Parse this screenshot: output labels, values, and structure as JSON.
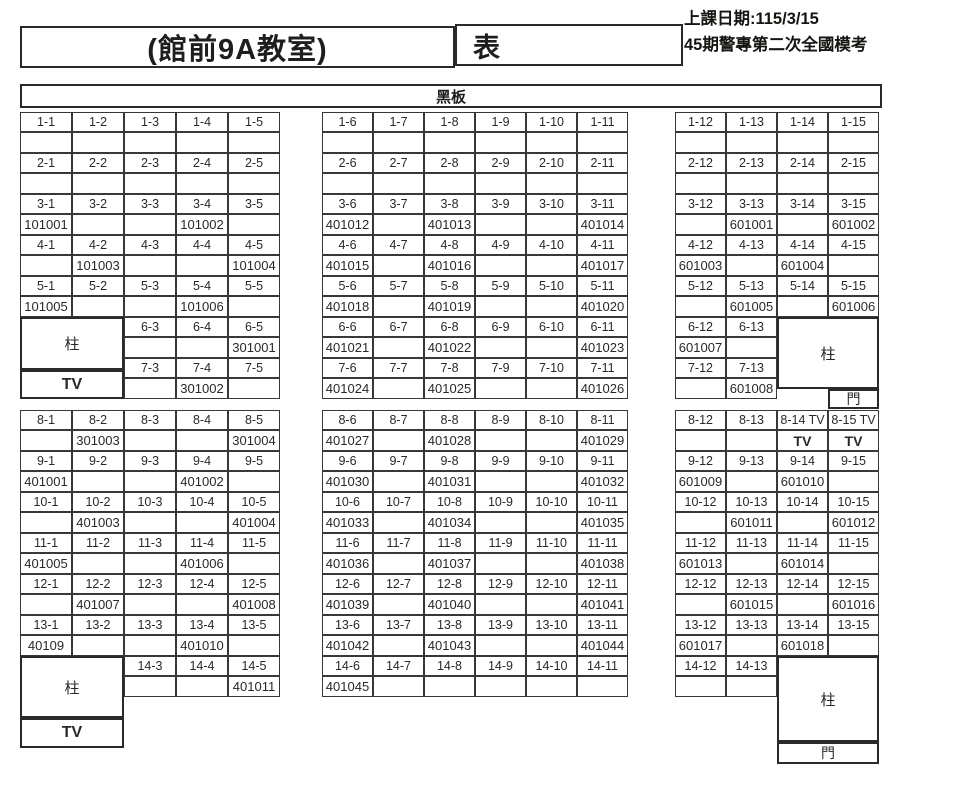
{
  "header": {
    "room_title": "(館前9A教室)",
    "sheet_label": "表",
    "date_line1": "上課日期:115/3/15",
    "date_line2": "45期警專第二次全國模考"
  },
  "blackboard_label": "黑板",
  "fixtures": {
    "pillar": "柱",
    "tv": "TV",
    "door": "門"
  },
  "seat_sections": [
    {
      "id": "left-top",
      "first_col": 1,
      "cols": 5,
      "rows": [
        {
          "start_col": 1,
          "labels": [
            "1-1",
            "1-2",
            "1-3",
            "1-4",
            "1-5"
          ],
          "values": [
            "",
            "",
            "",
            "",
            ""
          ]
        },
        {
          "start_col": 1,
          "labels": [
            "2-1",
            "2-2",
            "2-3",
            "2-4",
            "2-5"
          ],
          "values": [
            "",
            "",
            "",
            "",
            ""
          ]
        },
        {
          "start_col": 1,
          "labels": [
            "3-1",
            "3-2",
            "3-3",
            "3-4",
            "3-5"
          ],
          "values": [
            "101001",
            "",
            "",
            "101002",
            ""
          ]
        },
        {
          "start_col": 1,
          "labels": [
            "4-1",
            "4-2",
            "4-3",
            "4-4",
            "4-5"
          ],
          "values": [
            "",
            "101003",
            "",
            "",
            "101004"
          ]
        },
        {
          "start_col": 1,
          "labels": [
            "5-1",
            "5-2",
            "5-3",
            "5-4",
            "5-5"
          ],
          "values": [
            "101005",
            "",
            "",
            "101006",
            ""
          ]
        },
        {
          "start_col": 3,
          "labels": [
            "6-3",
            "6-4",
            "6-5"
          ],
          "values": [
            "",
            "",
            "301001"
          ]
        },
        {
          "start_col": 3,
          "labels": [
            "7-3",
            "7-4",
            "7-5"
          ],
          "values": [
            "",
            "301002",
            ""
          ]
        }
      ]
    },
    {
      "id": "middle-top",
      "first_col": 6,
      "cols": 6,
      "rows": [
        {
          "start_col": 6,
          "labels": [
            "1-6",
            "1-7",
            "1-8",
            "1-9",
            "1-10",
            "1-11"
          ],
          "values": [
            "",
            "",
            "",
            "",
            "",
            ""
          ]
        },
        {
          "start_col": 6,
          "labels": [
            "2-6",
            "2-7",
            "2-8",
            "2-9",
            "2-10",
            "2-11"
          ],
          "values": [
            "",
            "",
            "",
            "",
            "",
            ""
          ]
        },
        {
          "start_col": 6,
          "labels": [
            "3-6",
            "3-7",
            "3-8",
            "3-9",
            "3-10",
            "3-11"
          ],
          "values": [
            "401012",
            "",
            "401013",
            "",
            "",
            "401014"
          ]
        },
        {
          "start_col": 6,
          "labels": [
            "4-6",
            "4-7",
            "4-8",
            "4-9",
            "4-10",
            "4-11"
          ],
          "values": [
            "401015",
            "",
            "401016",
            "",
            "",
            "401017"
          ]
        },
        {
          "start_col": 6,
          "labels": [
            "5-6",
            "5-7",
            "5-8",
            "5-9",
            "5-10",
            "5-11"
          ],
          "values": [
            "401018",
            "",
            "401019",
            "",
            "",
            "401020"
          ]
        },
        {
          "start_col": 6,
          "labels": [
            "6-6",
            "6-7",
            "6-8",
            "6-9",
            "6-10",
            "6-11"
          ],
          "values": [
            "401021",
            "",
            "401022",
            "",
            "",
            "401023"
          ]
        },
        {
          "start_col": 6,
          "labels": [
            "7-6",
            "7-7",
            "7-8",
            "7-9",
            "7-10",
            "7-11"
          ],
          "values": [
            "401024",
            "",
            "401025",
            "",
            "",
            "401026"
          ]
        }
      ]
    },
    {
      "id": "right-top",
      "first_col": 12,
      "cols": 4,
      "rows": [
        {
          "start_col": 12,
          "labels": [
            "1-12",
            "1-13",
            "1-14",
            "1-15"
          ],
          "values": [
            "",
            "",
            "",
            ""
          ]
        },
        {
          "start_col": 12,
          "labels": [
            "2-12",
            "2-13",
            "2-14",
            "2-15"
          ],
          "values": [
            "",
            "",
            "",
            ""
          ]
        },
        {
          "start_col": 12,
          "labels": [
            "3-12",
            "3-13",
            "3-14",
            "3-15"
          ],
          "values": [
            "",
            "601001",
            "",
            "601002"
          ]
        },
        {
          "start_col": 12,
          "labels": [
            "4-12",
            "4-13",
            "4-14",
            "4-15"
          ],
          "values": [
            "601003",
            "",
            "601004",
            ""
          ]
        },
        {
          "start_col": 12,
          "labels": [
            "5-12",
            "5-13",
            "5-14",
            "5-15"
          ],
          "values": [
            "",
            "601005",
            "",
            "601006"
          ]
        },
        {
          "start_col": 12,
          "labels": [
            "6-12",
            "6-13"
          ],
          "values": [
            "601007",
            ""
          ]
        },
        {
          "start_col": 12,
          "labels": [
            "7-12",
            "7-13"
          ],
          "values": [
            "",
            "601008"
          ]
        }
      ]
    },
    {
      "id": "left-bottom",
      "first_col": 1,
      "cols": 5,
      "rows": [
        {
          "start_col": 1,
          "labels": [
            "8-1",
            "8-2",
            "8-3",
            "8-4",
            "8-5"
          ],
          "values": [
            "",
            "301003",
            "",
            "",
            "301004"
          ]
        },
        {
          "start_col": 1,
          "labels": [
            "9-1",
            "9-2",
            "9-3",
            "9-4",
            "9-5"
          ],
          "values": [
            "401001",
            "",
            "",
            "401002",
            ""
          ]
        },
        {
          "start_col": 1,
          "labels": [
            "10-1",
            "10-2",
            "10-3",
            "10-4",
            "10-5"
          ],
          "values": [
            "",
            "401003",
            "",
            "",
            "401004"
          ]
        },
        {
          "start_col": 1,
          "labels": [
            "11-1",
            "11-2",
            "11-3",
            "11-4",
            "11-5"
          ],
          "values": [
            "401005",
            "",
            "",
            "401006",
            ""
          ]
        },
        {
          "start_col": 1,
          "labels": [
            "12-1",
            "12-2",
            "12-3",
            "12-4",
            "12-5"
          ],
          "values": [
            "",
            "401007",
            "",
            "",
            "401008"
          ]
        },
        {
          "start_col": 1,
          "labels": [
            "13-1",
            "13-2",
            "13-3",
            "13-4",
            "13-5"
          ],
          "values": [
            "40109",
            "",
            "",
            "401010",
            ""
          ]
        },
        {
          "start_col": 3,
          "labels": [
            "14-3",
            "14-4",
            "14-5"
          ],
          "values": [
            "",
            "",
            "401011"
          ]
        }
      ]
    },
    {
      "id": "middle-bottom",
      "first_col": 6,
      "cols": 6,
      "rows": [
        {
          "start_col": 6,
          "labels": [
            "8-6",
            "8-7",
            "8-8",
            "8-9",
            "8-10",
            "8-11"
          ],
          "values": [
            "401027",
            "",
            "401028",
            "",
            "",
            "401029"
          ]
        },
        {
          "start_col": 6,
          "labels": [
            "9-6",
            "9-7",
            "9-8",
            "9-9",
            "9-10",
            "9-11"
          ],
          "values": [
            "401030",
            "",
            "401031",
            "",
            "",
            "401032"
          ]
        },
        {
          "start_col": 6,
          "labels": [
            "10-6",
            "10-7",
            "10-8",
            "10-9",
            "10-10",
            "10-11"
          ],
          "values": [
            "401033",
            "",
            "401034",
            "",
            "",
            "401035"
          ]
        },
        {
          "start_col": 6,
          "labels": [
            "11-6",
            "11-7",
            "11-8",
            "11-9",
            "11-10",
            "11-11"
          ],
          "values": [
            "401036",
            "",
            "401037",
            "",
            "",
            "401038"
          ]
        },
        {
          "start_col": 6,
          "labels": [
            "12-6",
            "12-7",
            "12-8",
            "12-9",
            "12-10",
            "12-11"
          ],
          "values": [
            "401039",
            "",
            "401040",
            "",
            "",
            "401041"
          ]
        },
        {
          "start_col": 6,
          "labels": [
            "13-6",
            "13-7",
            "13-8",
            "13-9",
            "13-10",
            "13-11"
          ],
          "values": [
            "401042",
            "",
            "401043",
            "",
            "",
            "401044"
          ]
        },
        {
          "start_col": 6,
          "labels": [
            "14-6",
            "14-7",
            "14-8",
            "14-9",
            "14-10",
            "14-11"
          ],
          "values": [
            "401045",
            "",
            "",
            "",
            "",
            ""
          ]
        }
      ]
    },
    {
      "id": "right-bottom",
      "first_col": 12,
      "cols": 4,
      "rows": [
        {
          "start_col": 12,
          "labels": [
            "8-12",
            "8-13",
            "8-14 TV",
            "8-15 TV"
          ],
          "values": [
            "",
            "",
            "TV",
            "TV"
          ]
        },
        {
          "start_col": 12,
          "labels": [
            "9-12",
            "9-13",
            "9-14",
            "9-15"
          ],
          "values": [
            "601009",
            "",
            "601010",
            ""
          ]
        },
        {
          "start_col": 12,
          "labels": [
            "10-12",
            "10-13",
            "10-14",
            "10-15"
          ],
          "values": [
            "",
            "601011",
            "",
            "601012"
          ]
        },
        {
          "start_col": 12,
          "labels": [
            "11-12",
            "11-13",
            "11-14",
            "11-15"
          ],
          "values": [
            "601013",
            "",
            "601014",
            ""
          ]
        },
        {
          "start_col": 12,
          "labels": [
            "12-12",
            "12-13",
            "12-14",
            "12-15"
          ],
          "values": [
            "",
            "601015",
            "",
            "601016"
          ]
        },
        {
          "start_col": 12,
          "labels": [
            "13-12",
            "13-13",
            "13-14",
            "13-15"
          ],
          "values": [
            "601017",
            "",
            "601018",
            ""
          ]
        },
        {
          "start_col": 12,
          "labels": [
            "14-12",
            "14-13"
          ],
          "values": [
            "",
            ""
          ]
        }
      ]
    }
  ]
}
